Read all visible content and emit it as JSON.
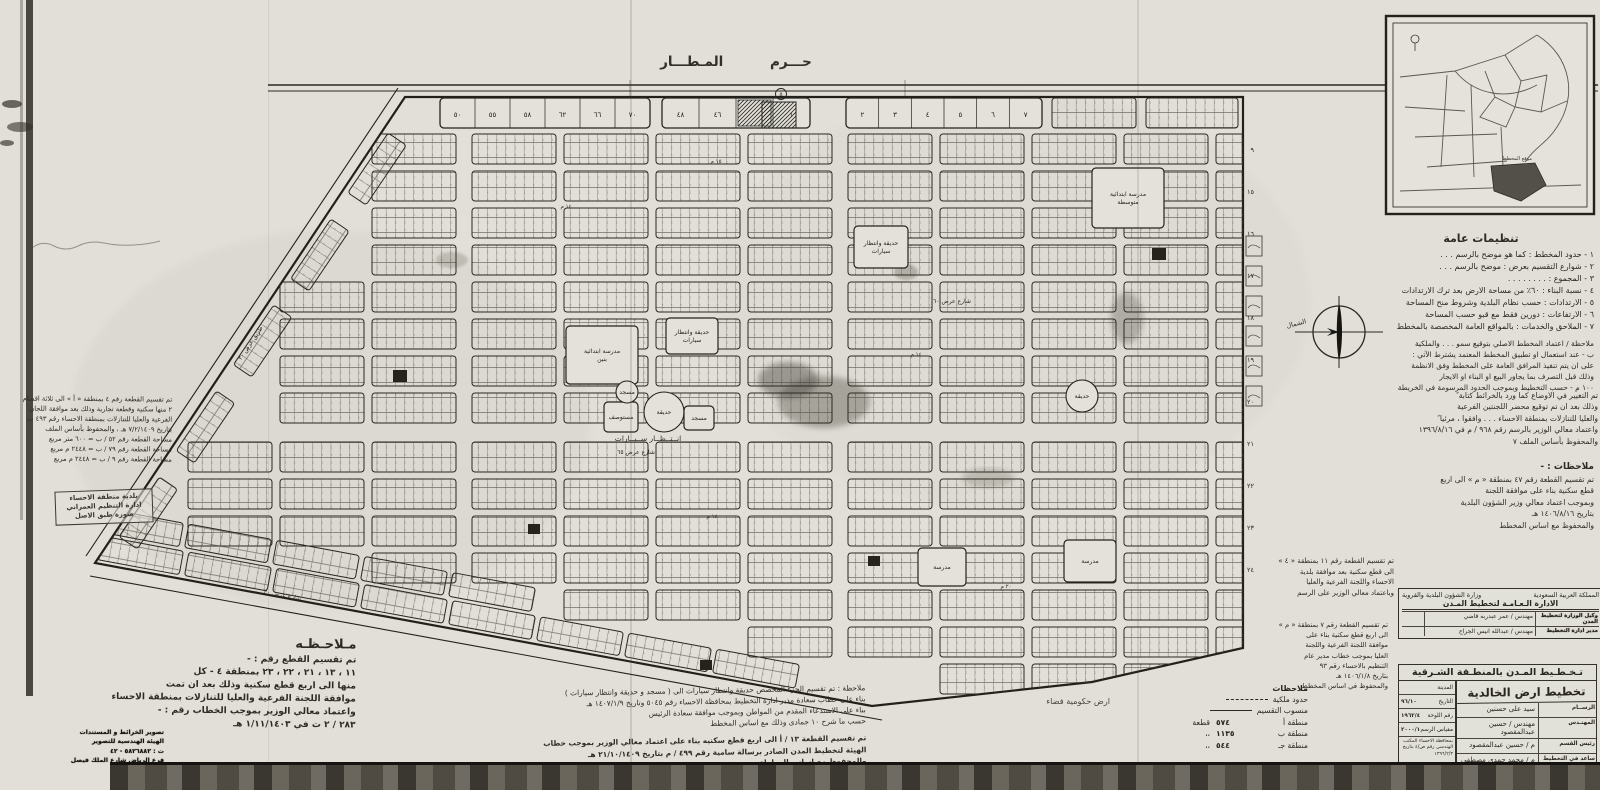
{
  "sheet": {
    "airport_label": "حـــرم المـطـــار",
    "north_label": "الشمال"
  },
  "map": {
    "plot_texture_digits": "٦٤",
    "circled_mark": "٥",
    "top_strip": [
      {
        "x": 440,
        "w": 210,
        "cells": [
          "٧٠",
          "٦٦",
          "٦٢",
          "٥٨",
          "٥٥",
          "٥٠"
        ]
      },
      {
        "x": 662,
        "w": 148,
        "cells": [
          "١",
          "#",
          "٤٦",
          "٤٨"
        ]
      },
      {
        "x": 846,
        "w": 196,
        "cells": [
          "٧",
          "٦",
          "٥",
          "٤",
          "٣",
          "٢"
        ]
      }
    ],
    "right_edge_numbers": [
      "٩",
      "١٥",
      "١٦",
      "١٧",
      "١٨",
      "١٩",
      "٢٠",
      "٢١",
      "٢٢",
      "٢٣",
      "٢٤"
    ],
    "features": [
      {
        "t": "rect",
        "label": "مدرسة ابتدائية بنين",
        "x": 566,
        "y": 326,
        "w": 72,
        "h": 58
      },
      {
        "t": "rect",
        "label": "مدرسة ابتدائية متوسطة",
        "x": 1092,
        "y": 168,
        "w": 72,
        "h": 60
      },
      {
        "t": "rect",
        "label": "حديقة وانتظار سيارات",
        "x": 666,
        "y": 318,
        "w": 52,
        "h": 36
      },
      {
        "t": "rect",
        "label": "حديقة وانتظار سيارات",
        "x": 854,
        "y": 226,
        "w": 54,
        "h": 42
      },
      {
        "t": "rect",
        "label": "مستوصف",
        "x": 604,
        "y": 402,
        "w": 34,
        "h": 30
      },
      {
        "t": "circle",
        "label": "حديقة",
        "cx": 664,
        "cy": 412,
        "r": 20
      },
      {
        "t": "circle",
        "label": "مسجد",
        "cx": 627,
        "cy": 392,
        "r": 11
      },
      {
        "t": "rect",
        "label": "مسجد",
        "x": 684,
        "y": 406,
        "w": 30,
        "h": 24
      },
      {
        "t": "rect",
        "label": "مدرسة",
        "x": 918,
        "y": 548,
        "w": 48,
        "h": 38
      },
      {
        "t": "rect",
        "label": "مدرسة",
        "x": 1064,
        "y": 540,
        "w": 52,
        "h": 42
      },
      {
        "t": "circle",
        "label": "حديقة",
        "cx": 1082,
        "cy": 396,
        "r": 16
      },
      {
        "t": "hatch",
        "x": 762,
        "y": 102,
        "w": 34,
        "h": 26
      },
      {
        "t": "solid",
        "x": 393,
        "y": 370,
        "w": 14,
        "h": 12
      },
      {
        "t": "solid",
        "x": 868,
        "y": 556,
        "w": 12,
        "h": 10
      },
      {
        "t": "solid",
        "x": 700,
        "y": 660,
        "w": 12,
        "h": 10
      },
      {
        "t": "solid",
        "x": 1152,
        "y": 248,
        "w": 14,
        "h": 12
      },
      {
        "t": "solid",
        "x": 528,
        "y": 524,
        "w": 12,
        "h": 10
      }
    ],
    "street_labels": [
      {
        "text": "انــتــظــار  ســيــارات",
        "x": 648,
        "y": 441,
        "r": 0,
        "s": 7.5
      },
      {
        "text": "شارع  عرض  ٦٥",
        "x": 636,
        "y": 454,
        "r": 0,
        "s": 6
      },
      {
        "text": "شارع  عرض  ٦٠",
        "x": 952,
        "y": 303,
        "r": 0,
        "s": 6
      },
      {
        "text": "شارع عرض ٣٠",
        "x": 282,
        "y": 597,
        "r": 11,
        "s": 6
      },
      {
        "text": "طريق عرض ٣٠",
        "x": 252,
        "y": 344,
        "r": -56,
        "s": 6
      },
      {
        "text": "١٤ م",
        "x": 566,
        "y": 208,
        "r": 0,
        "s": 5.5
      },
      {
        "text": "١٤ م",
        "x": 712,
        "y": 518,
        "r": 0,
        "s": 5.5
      },
      {
        "text": "١٤ م",
        "x": 916,
        "y": 356,
        "r": 0,
        "s": 5.5
      },
      {
        "text": "٢٠ م",
        "x": 1006,
        "y": 588,
        "r": 0,
        "s": 5.5
      },
      {
        "text": "١٥ م",
        "x": 716,
        "y": 163,
        "r": 0,
        "s": 5.5
      }
    ]
  },
  "inset": {
    "site_label": "موقع المخطط"
  },
  "annotations": {
    "heading": "تنظيمات عامة",
    "items": [
      "١ - حدود المخطط : كما هو موضح بالرسم . . .",
      "٢ - شوارع التقسيم بعرض : موضح بالرسم . . .",
      "٣ - المجموع : . . . . . . . .",
      "٤ - نسبة البناء : ٦٠٪ من مساحة الارض بعد ترك الارتدادات",
      "٥ - الارتدادات : حسب نظام البلدية وشروط منح المساحة",
      "٦ - الارتفاعات : دورين فقط مع قبو حسب المساحة",
      "٧ - الملاحق والخدمات : بالمواقع العامة المخصصة بالمخطط"
    ],
    "sub_items": [
      "ملاحظة / اعتماد المخطط الاصلي بتوقيع سمو . . . والملكية",
      "ب - عند استعمال او تطبيق المخطط المعتمد يشترط الآتي :",
      "على ان يتم تنفيذ المرافق العامة على المخطط وفق الانظمة",
      "وذلك قبل التصرف بما يجاور البيع او البناء او الايجار",
      "١٠٠ م - حسب التخطيط وبموجب الحدود المرسومة في الخريطة"
    ],
    "para_change": [
      "تم التغيير في الاوضاع كما ورد بالخرائط كتابة ً",
      "وذلك بعد ان تم توقيع محضر اللجنتين الفرعية",
      "والعليا للتنازلات بمنطقة الاحساء . . . وافقوا ، مرئيا ً",
      "واعتماد معالي الوزير بالرسم رقم ٩٦٨ / م في ١٣٩٦/٨/١٦",
      "والمحفوظ بأساس الملف ٧"
    ],
    "mid_heading": "ملاحظات : -",
    "mid_para1": [
      "تم تقسيم القطعة رقم ٤٧ بمنطقة « م » الى اربع",
      "قطع سكنية بناء على موافقة اللجنة",
      "وبموجب اعتماد معالي وزير الشؤون البلدية",
      "بتاريخ ١٤٠٦/٨/١٦ هـ",
      "والمحفوظ مع اساس المخطط"
    ],
    "mid_para2": [
      "تم تقسيم القطعة رقم ١١ بمنطقة « ٤ »",
      "الى قطع سكنية بعد موافقة بلدية",
      "الاحساء واللجنة الفرعية والعليا",
      "وباعتماد معالي الوزير على الرسم"
    ],
    "left_para": [
      "تم تقسيم القطعة رقم ٧ بمنطقة « م »",
      "الى اربع قطع سكنية بناء على",
      "موافقة اللجنة الفرعية واللجنة",
      "العليا بموجب خطاب مدير عام",
      "التنظيم بالاحساء رقم ٩٣",
      "بتاريخ ١٤٠٦/١/٨ هـ",
      "والمحفوظ في اساس المخطط"
    ]
  },
  "legend": {
    "heading": "ملاحظات",
    "line_rows": [
      {
        "label": "حدود ملكية",
        "style": "dashed"
      },
      {
        "label": "منسوب التقسيم",
        "style": "solid"
      }
    ],
    "zones": [
      {
        "name": "منطقة أ",
        "count": "٥٧٤",
        "unit": "قطعة"
      },
      {
        "name": "منطقة ب",
        "count": "١١٣٥",
        "unit": "،،"
      },
      {
        "name": "منطقة جـ",
        "count": "٥٤٤",
        "unit": "،،"
      }
    ],
    "vacant_label": "ارض حكومية فضاء"
  },
  "title_block": {
    "kingdom": "المملكة العربية السعودية",
    "ministry": "وزارة الشؤون البلدية والقروية",
    "department": "الادارة الـعـامـة لتخطيط المـدن",
    "officials": [
      {
        "label": "وكيل الوزارة لتخطيط المدن",
        "value": "مهندس / عمر عبدربه قاضي"
      },
      {
        "label": "مدير ادارة التخطيط",
        "value": "مهندس / عبدالله انيس الجراح"
      }
    ],
    "region_strip": "تـخـطـيط المـدن بالمنطـقة الشـرقية",
    "project_title": "تخطيط ارض الخالدية",
    "info": [
      {
        "label": "المدينة",
        "value": ""
      },
      {
        "label": "التاريخ",
        "value": "٩٦/١٠"
      },
      {
        "label": "رقم اللوحة",
        "value": "١٩٦٢/٤"
      },
      {
        "label": "مقياس الرسم",
        "value": "٢٠٠٠/١"
      }
    ],
    "side_note": "بمحافظة الاحساء المكتب الهندسي رقم ص/٤ بتاريخ ١٣٩٦/٢/٣",
    "staff": [
      {
        "label": "الرســام",
        "value": "سيد على حسنين"
      },
      {
        "label": "المهنـدس",
        "value": "مهندس / حسين عبدالمقصود"
      },
      {
        "label": "رئيس القسم",
        "value": "م / حسين عبدالمقصود"
      },
      {
        "label": "ساعد في التخطيط",
        "value": "م / محمد حمدي مصطفى"
      },
      {
        "label": "مدير تخطيط المدن بالمنطقة الشرقية",
        "value": "عبدالرحمن الرويشد"
      }
    ]
  },
  "notes": {
    "bottom_left_heading": "مـلاحـظـه",
    "bottom_left": [
      "تم تقسيم القطع رقم : -",
      "١١ ، ١٣ ، ٢١ ، ٢٢ ، ٢٣ بمنطقة ٤ - كل",
      "منها الى اربع قطع سكنية وذلك بعد ان تمت",
      "موافقة اللجنة الفرعية والعليا للتنازلات بمنطقة الاحساء",
      "واعتماد معالي الوزير بموجب الخطاب رقم : -",
      "٢٨٣ / ٢ ت  في  ١/١١/١٤٠٣ هـ"
    ],
    "left_margin": [
      "تم تقسيم القطعة رقم ٤ بمنطقة « أ » الى ثلاثة اقسام",
      "٢ منها سكنية وقطعة تجارية وذلك بعد موافقة اللجان",
      "الفرعية والعليا للتنازلات بمنطقة الاحساء رقم ٤٩٣ ت",
      "بتاريخ ٧/٢/١٤٠٩ هـ ، والمحفوظ بأساس الملف",
      "مساحة القطعة رقم ٥٢ / ب = ٦٠٠ متر مربع",
      "مساحة القطعة رقم ٧٩ / ب = ٢٤٤٨ م مربع",
      "مساحة القطعة رقم ٩ / ب = ٢٤٤٨ م مربع"
    ],
    "municipality_stamp": [
      "بلدية منطقة الاحساء",
      "ادارة التنظيم العمراني",
      "صورة طبق الاصل"
    ],
    "bottom_center_1": [
      "ملاحظة : تم تقسيم الجزء المخصص حديقة وانتظار سيارات الى ( مسجد و حديقة وانتظار سيارات )",
      "بناء على خطاب سعادة مدير ادارة التخطيط بمحافظة الاحساء رقم ٥٠٤٥ وتاريخ ١٤٠٧/١/٩ هـ",
      "بناء على الاستدعاء المقدم من المواطن وبموجب موافقة سعادة الرئيس",
      "حسب ما شرح ١٠ جمادى وذلك مع اساس المخطط"
    ],
    "bottom_center_2": [
      "تم تقسيم القطعة ١٣ / أ الى اربع قطع سكنيه بناء على اعتماد معالي الوزير بموجب خطاب",
      "الهيئة لتخطيط المدن الصادر برسالة سامية رقم ٤٩٩ / م بتاريخ ٢١/١٠/١٤٠٩ هـ",
      "والمحفوظ مع اساس المعاملة"
    ],
    "corner_stamp": [
      "تصوير الخرائط و المستندات",
      "الهيئة الهندسية للتصوير",
      "ت : ٥٨٢٦٨٨٢ - ٤٢",
      "فرع الرياض شارع الملك فيصل"
    ]
  }
}
